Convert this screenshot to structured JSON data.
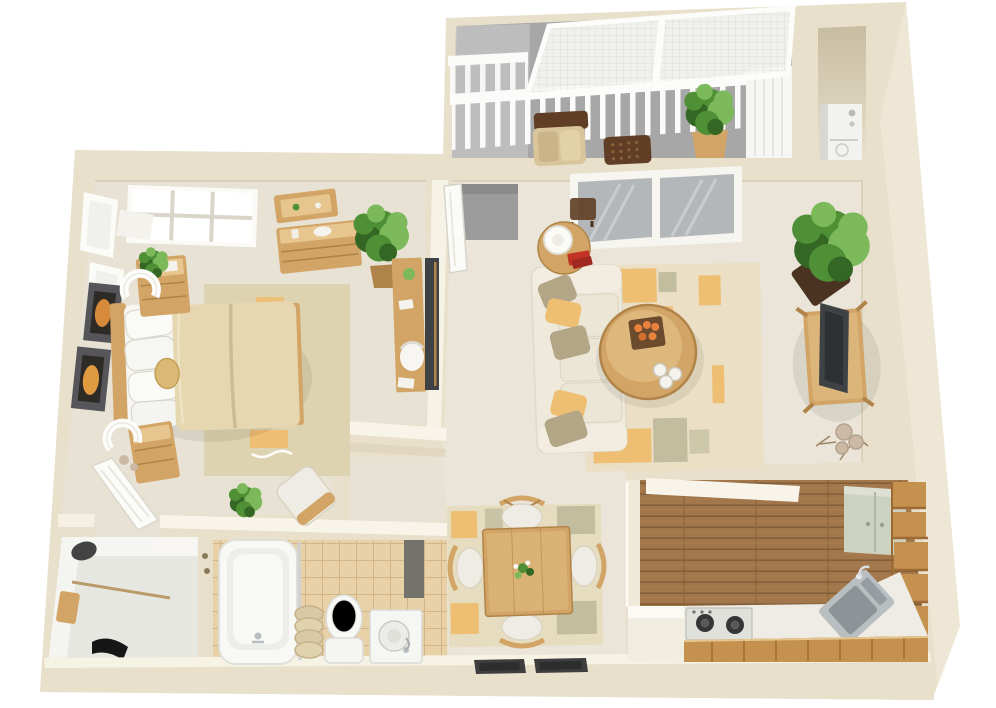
{
  "meta": {
    "title": "3D isometric floor plan render of a one-bedroom apartment",
    "view": "top-down 3D render, white background, no text labels"
  },
  "palette": {
    "pageBg": "#ffffff",
    "wall": "#e8e0cb",
    "wallTop": "#f8f4e9",
    "wallShade": "#d7cdb2",
    "floorBed": "#e7e2d4",
    "floorLiving": "#eae5d8",
    "rugBed": "#ded3b1",
    "rugLiving": "#ebdfc5",
    "rugDining": "#e6dcc0",
    "orange": "#eebe72",
    "olive": "#c2bd9e",
    "khaki": "#b2a686",
    "wood": "#d2a567",
    "woodDark": "#b08449",
    "woodLight": "#e6c68e",
    "duvet": "#e6d7b1",
    "duvetSeam": "#cdbb92",
    "whiteItem": "#f7f6f2",
    "softWhite": "#eeece4",
    "balconyFloor": "#a7a7a7",
    "balconyLight": "#c4c4c4",
    "glass": "#b4b7ba",
    "glassLight": "#d0d2d4",
    "entryGray": "#9c9c9c",
    "kitchenFloor": "#a3774c",
    "plankLine": "#7e5a36",
    "cabinet": "#c4914f",
    "cabinetDark": "#9e6a34",
    "sage": "#cdd1c0",
    "steel": "#b9bec1",
    "steelDark": "#8d9498",
    "tile": "#e9d1a7",
    "tileLine": "#d2b488",
    "tub": "#f8f8f5",
    "closetFloor": "#e7e7e1",
    "closetWall": "#f5f5f2",
    "plant": "#4f9036",
    "plantLight": "#7cb95b",
    "plantDark": "#336723",
    "planter": "#4a3421",
    "darkBrown": "#5f3e25",
    "wicker": "#d9c59b",
    "tvDark": "#3f4245",
    "charcoal": "#434343",
    "burner": "#353535",
    "stove": "#e0e1db",
    "red": "#c23326",
    "orangeBright": "#e8823c",
    "taupe": "#cbb9a5",
    "matDark": "#3e3e3e"
  },
  "rooms": {
    "balcony": {
      "label": "balcony",
      "items": [
        "pergola-mesh-roof",
        "white-railing",
        "wicker-armchair",
        "lattice-ottoman",
        "potted-plant",
        "privacy-screen"
      ]
    },
    "laundry_nook": {
      "label": "laundry nook",
      "items": [
        "stacked-washer-dryer"
      ]
    },
    "bedroom": {
      "label": "bedroom",
      "items": [
        "skylight-window",
        "side-windows",
        "framed-art-upper",
        "framed-art-lower",
        "wall-shelf",
        "dresser",
        "potted-plant",
        "desk",
        "desk-chair",
        "wall-tv",
        "nightstand-upper",
        "arc-lamp-upper",
        "nightstand-lower",
        "arc-lamp-lower",
        "double-bed",
        "area-rug",
        "round-cushion",
        "accent-chair",
        "floor-plant",
        "open-door"
      ]
    },
    "living_room": {
      "label": "living room",
      "items": [
        "entry-recess",
        "entry-door",
        "sliding-glass-door",
        "window-bench",
        "round-side-table",
        "table-lamp",
        "red-books",
        "sofa",
        "throw-pillows",
        "area-rug",
        "oval-coffee-table",
        "decor-tray",
        "white-cups",
        "potted-tree",
        "planter-box",
        "tv-console",
        "flatscreen-tv",
        "dried-decor"
      ]
    },
    "dining_area": {
      "label": "dining area",
      "items": [
        "area-rug",
        "square-table",
        "centerpiece-plant",
        "chair-north",
        "chair-west",
        "chair-east",
        "chair-south",
        "doormat-left",
        "doormat-right"
      ]
    },
    "kitchen": {
      "label": "kitchen",
      "items": [
        "plank-floor",
        "upper-cabinet",
        "cabinet-stack",
        "corner-sink",
        "faucet",
        "cooktop-stove",
        "counter",
        "base-cabinets",
        "half-wall"
      ]
    },
    "bathroom": {
      "label": "bathroom",
      "items": [
        "bathtub",
        "shower-glass",
        "rolled-towels",
        "toilet",
        "vanity-sink",
        "dark-recess",
        "tile-floor"
      ]
    },
    "closet": {
      "label": "walk-in closet",
      "items": [
        "hanging-rod",
        "hat",
        "bag",
        "shoes",
        "shelf",
        "door-knobs"
      ]
    }
  }
}
